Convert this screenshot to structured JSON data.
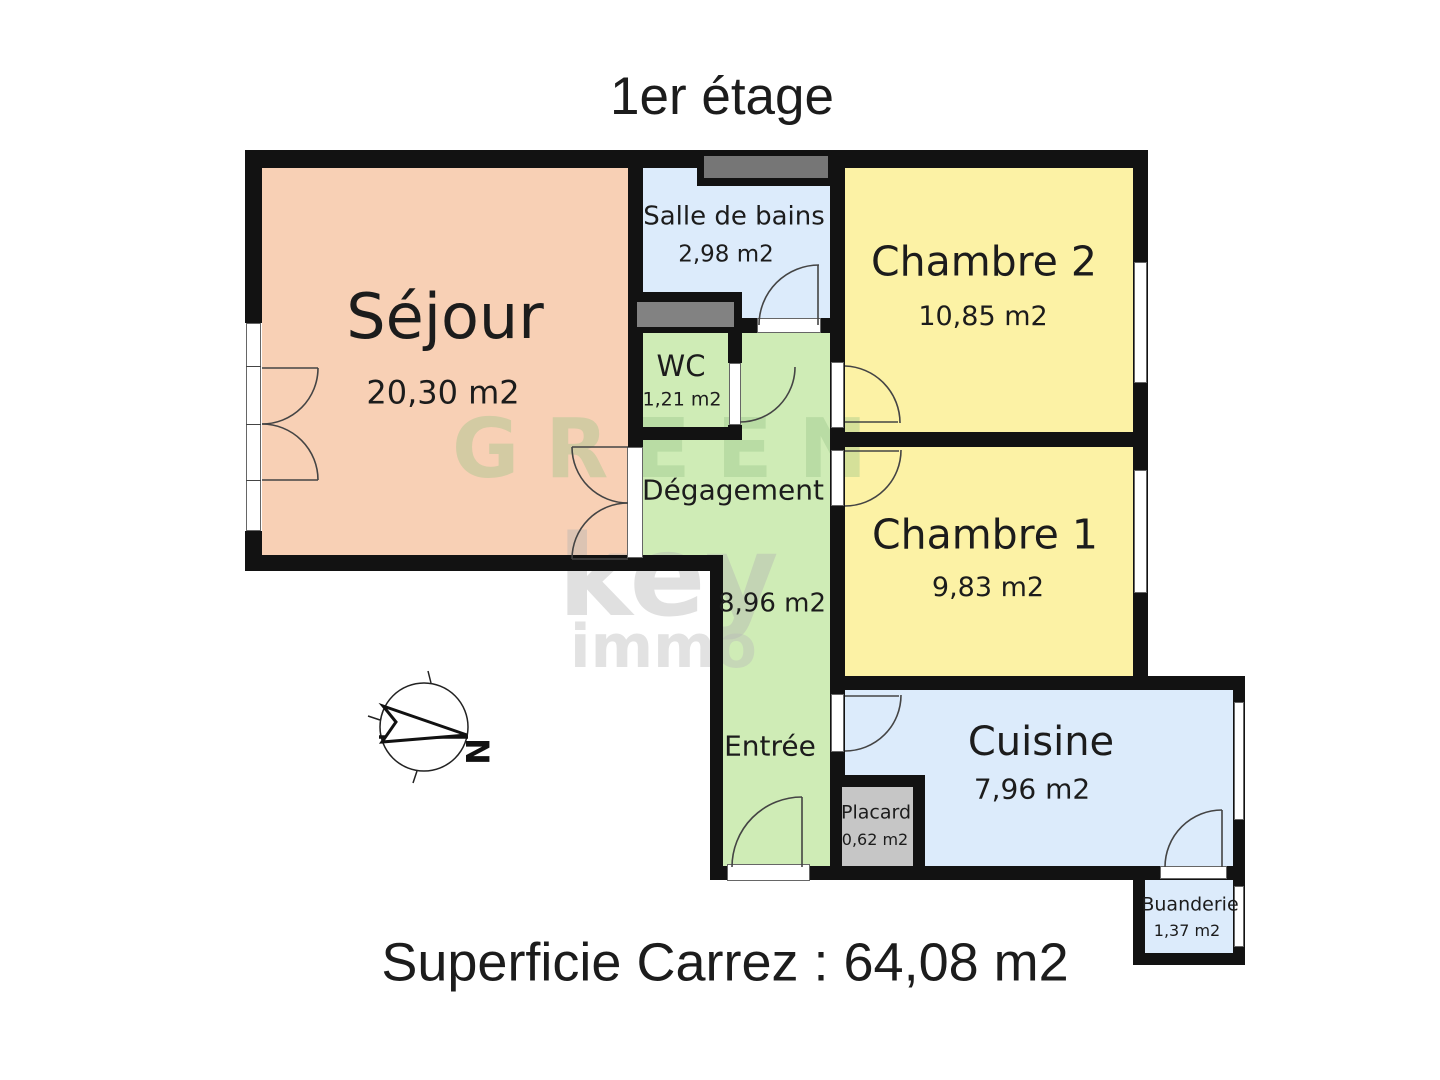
{
  "title": "1er étage",
  "footer": "Superficie Carrez : 64,08 m2",
  "compass": {
    "north_label": "N"
  },
  "watermark": {
    "line1": "GREEN",
    "line2": "key",
    "line3": "immo"
  },
  "rooms": {
    "sejour": {
      "name": "Séjour",
      "area": "20,30 m2"
    },
    "salle_de_bains": {
      "name": "Salle de bains",
      "area": "2,98 m2"
    },
    "wc": {
      "name": "WC",
      "area": "1,21 m2"
    },
    "degagement": {
      "name": "Dégagement",
      "area": "8,96 m2"
    },
    "entree": {
      "name": "Entrée"
    },
    "chambre2": {
      "name": "Chambre 2",
      "area": "10,85 m2"
    },
    "chambre1": {
      "name": "Chambre 1",
      "area": "9,83 m2"
    },
    "cuisine": {
      "name": "Cuisine",
      "area": "7,96 m2"
    },
    "placard": {
      "name": "Placard",
      "area": "0,62 m2"
    },
    "buanderie": {
      "name": "Buanderie",
      "area": "1,37 m2"
    }
  },
  "colors": {
    "sejour": "#f8d0b5",
    "bedroom": "#fcf2a5",
    "wet_room": "#dcebfb",
    "circulation": "#cfecb6",
    "duct_dark": "#767676",
    "duct_light": "#828282",
    "placard": "#c6c6c6",
    "wall": "#121212"
  }
}
